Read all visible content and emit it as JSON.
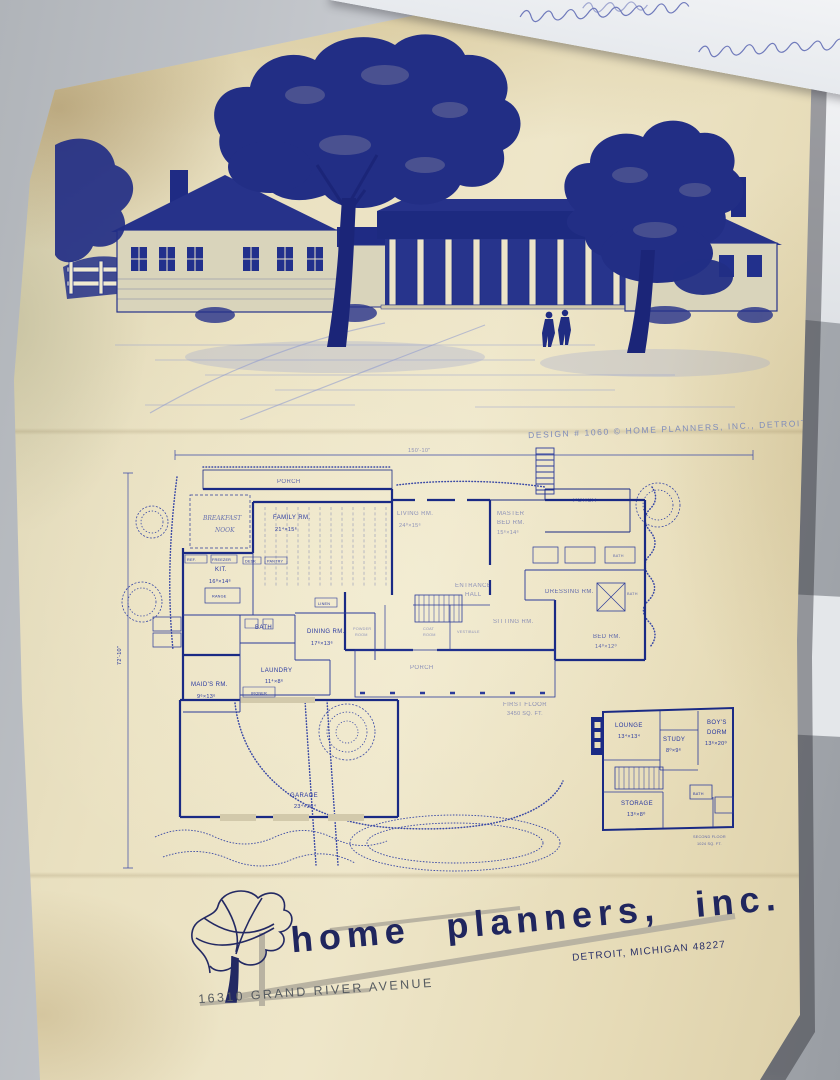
{
  "header": {
    "design_credit": "DESIGN # 1060 © HOME PLANNERS, INC., DETROIT",
    "handwriting_label": "illegible cursive handwriting on paper edge"
  },
  "dimensions": {
    "overall_width": "150'-10\"",
    "overall_depth": "72'-10\""
  },
  "first_floor": {
    "porch_top": "PORCH",
    "breakfast1": "BREAKFAST",
    "breakfast2": "NOOK",
    "family": "FAMILY RM.",
    "family_dim": "21⁴×15⁶",
    "kit": "KIT.",
    "kit_dim": "16⁰×14⁶",
    "range": "RANGE",
    "ref": "REF.",
    "freezer": "FREEZER",
    "desk": "DESK",
    "pantry": "PANTRY",
    "linen": "LINEN",
    "living": "LIVING RM.",
    "living_dim": "24⁰×15⁶",
    "master1": "MASTER",
    "master2": "BED RM.",
    "master_dim": "15⁶×14⁶",
    "dressing": "DRESSING RM.",
    "porch_right": "PORCH",
    "bath": "BATH",
    "dining": "DINING RM.",
    "dining_dim": "17⁶×13⁶",
    "laundry": "LAUNDRY",
    "laundry_dim": "11⁴×8⁶",
    "ironer": "IRONER",
    "maids": "MAID'S RM.",
    "maids_dim": "9⁶×13⁶",
    "entrance1": "ENTRANCE",
    "entrance2": "HALL",
    "powder1": "POWDER",
    "powder2": "ROOM",
    "coat1": "COAT",
    "coat2": "ROOM",
    "vestibule": "VESTIBULE",
    "sitting": "SITTING RM.",
    "bed": "BED RM.",
    "bed_dim": "14⁰×12⁰",
    "porch_center": "PORCH",
    "garage": "GARAGE",
    "garage_dim": "23⁴×26⁴",
    "caption1": "FIRST FLOOR",
    "caption2": "3450 SQ. FT."
  },
  "second_floor": {
    "lounge": "LOUNGE",
    "lounge_dim": "13⁴×13⁴",
    "study": "STUDY",
    "study_dim": "8⁰×9⁶",
    "boys1": "BOY'S",
    "boys2": "DORM",
    "boys_dim": "13⁶×20⁰",
    "storage": "STORAGE",
    "storage_dim": "13⁶×8⁰",
    "bath": "BATH",
    "caption1": "SECOND FLOOR",
    "caption2": "1024 SQ. FT."
  },
  "logo": {
    "company": "home planners, inc.",
    "city": "DETROIT, MICHIGAN 48227",
    "address": "16310 GRAND RIVER AVENUE"
  }
}
